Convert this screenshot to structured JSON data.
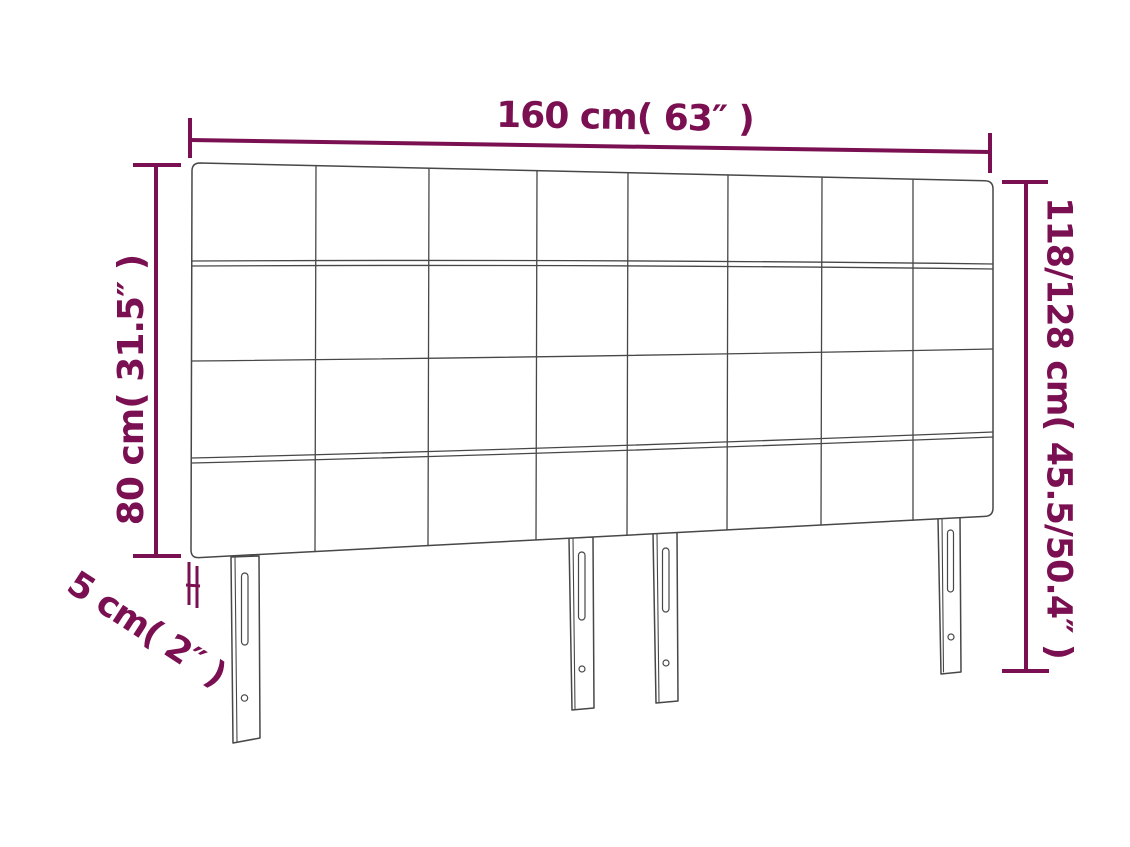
{
  "diagram": {
    "subject": "headboard-dimension-diagram",
    "accent_color": "#7a1051",
    "outline_color": "#474747",
    "background_color": "#ffffff",
    "structure": {
      "tufting_columns": 8,
      "tufting_rows": 4,
      "leg_count": 4
    },
    "dimensions": {
      "width": {
        "label": "160 cm( 63″ )",
        "value_cm": "160",
        "value_in": "63"
      },
      "panel_height": {
        "label": "80 cm( 31.5″ )",
        "value_cm": "80",
        "value_in": "31.5"
      },
      "total_height": {
        "label": "118/128 cm( 45.5/50.4″ )",
        "value_cm": "118/128",
        "value_in": "45.5/50.4"
      },
      "depth": {
        "label": "5 cm( 2″ )",
        "value_cm": "5",
        "value_in": "2"
      }
    }
  }
}
